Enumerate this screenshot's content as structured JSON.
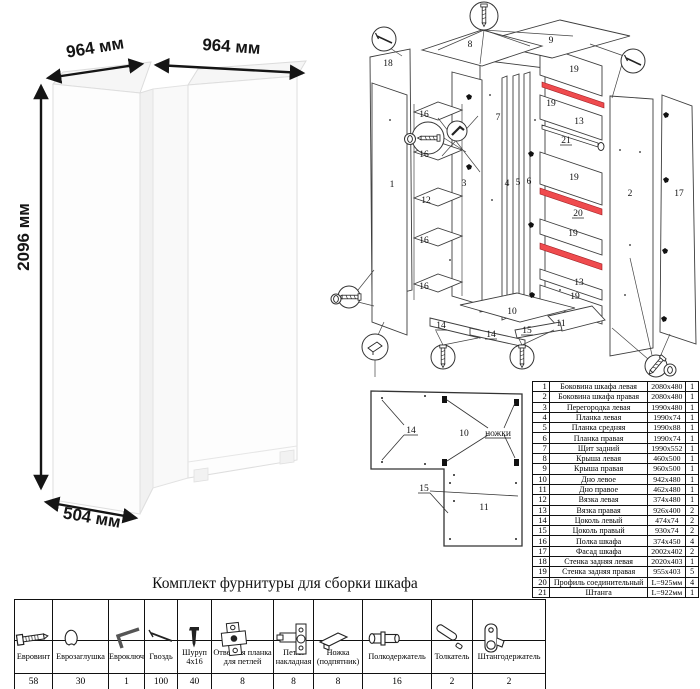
{
  "left_view": {
    "dims": [
      "964 мм",
      "964 мм",
      "2096 мм",
      "504 мм"
    ]
  },
  "exploded": {
    "labels": [
      "18",
      "8",
      "9",
      "19",
      "16",
      "16",
      "1",
      "3",
      "7",
      "4",
      "5",
      "6",
      "19",
      "13",
      "21",
      "19",
      "20",
      "19",
      "13",
      "19",
      "12",
      "16",
      "16",
      "10",
      "14",
      "14",
      "15",
      "11",
      "2",
      "17"
    ]
  },
  "plan": {
    "labels": [
      "14",
      "10",
      "ножки",
      "15",
      "11"
    ]
  },
  "parts": {
    "rows": [
      {
        "num": "1",
        "name": "Боковина шкафа левая",
        "size": "2080x480",
        "qty": "1"
      },
      {
        "num": "2",
        "name": "Боковина шкафа правая",
        "size": "2080x480",
        "qty": "1"
      },
      {
        "num": "3",
        "name": "Перегородка левая",
        "size": "1990x480",
        "qty": "1"
      },
      {
        "num": "4",
        "name": "Планка левая",
        "size": "1990x74",
        "qty": "1"
      },
      {
        "num": "5",
        "name": "Планка средняя",
        "size": "1990x88",
        "qty": "1"
      },
      {
        "num": "6",
        "name": "Планка правая",
        "size": "1990x74",
        "qty": "1"
      },
      {
        "num": "7",
        "name": "Щит задний",
        "size": "1990x552",
        "qty": "1"
      },
      {
        "num": "8",
        "name": "Крыша левая",
        "size": "460x500",
        "qty": "1"
      },
      {
        "num": "9",
        "name": "Крыша правая",
        "size": "960x500",
        "qty": "1"
      },
      {
        "num": "10",
        "name": "Дно левое",
        "size": "942x480",
        "qty": "1"
      },
      {
        "num": "11",
        "name": "Дно правое",
        "size": "462x480",
        "qty": "1"
      },
      {
        "num": "12",
        "name": "Вязка левая",
        "size": "374x480",
        "qty": "1"
      },
      {
        "num": "13",
        "name": "Вязка правая",
        "size": "926x400",
        "qty": "2"
      },
      {
        "num": "14",
        "name": "Цоколь левый",
        "size": "474x74",
        "qty": "2"
      },
      {
        "num": "15",
        "name": "Цоколь правый",
        "size": "930x74",
        "qty": "2"
      },
      {
        "num": "16",
        "name": "Полка шкафа",
        "size": "374x450",
        "qty": "4"
      },
      {
        "num": "17",
        "name": "Фасад шкафа",
        "size": "2002x402",
        "qty": "2"
      },
      {
        "num": "18",
        "name": "Стенка задняя левая",
        "size": "2020x403",
        "qty": "1"
      },
      {
        "num": "19",
        "name": "Стенка задняя правая",
        "size": "955x403",
        "qty": "5"
      },
      {
        "num": "20",
        "name": "Профиль соединительный",
        "size": "L=925мм",
        "qty": "4"
      },
      {
        "num": "21",
        "name": "Штанга",
        "size": "L=922мм",
        "qty": "1"
      }
    ]
  },
  "hardware": {
    "title": "Комплект фурнитуры для сборки шкафа",
    "items": [
      {
        "icon": "euroscrew-icon",
        "name": "Евровинт",
        "qty": "58"
      },
      {
        "icon": "eurocap-icon",
        "name": "Еврозаглушка",
        "qty": "30"
      },
      {
        "icon": "hexkey-icon",
        "name": "Евроключ",
        "qty": "1"
      },
      {
        "icon": "nail-icon",
        "name": "Гвоздь",
        "qty": "100"
      },
      {
        "icon": "screw-icon",
        "name": "Шуруп 4x16",
        "qty": "40"
      },
      {
        "icon": "hinge-plate-icon",
        "name": "Ответная планка для петлей",
        "qty": "8"
      },
      {
        "icon": "hinge-icon",
        "name": "Петля накладная",
        "qty": "8"
      },
      {
        "icon": "foot-icon",
        "name": "Ножка (подпятник)",
        "qty": "8"
      },
      {
        "icon": "shelf-pin-icon",
        "name": "Полкодержатель",
        "qty": "16"
      },
      {
        "icon": "pusher-icon",
        "name": "Толкатель",
        "qty": "2"
      },
      {
        "icon": "rod-holder-icon",
        "name": "Штангодержатель",
        "qty": "2"
      }
    ]
  },
  "colors": {
    "profile_red": "#ef4b4e"
  }
}
